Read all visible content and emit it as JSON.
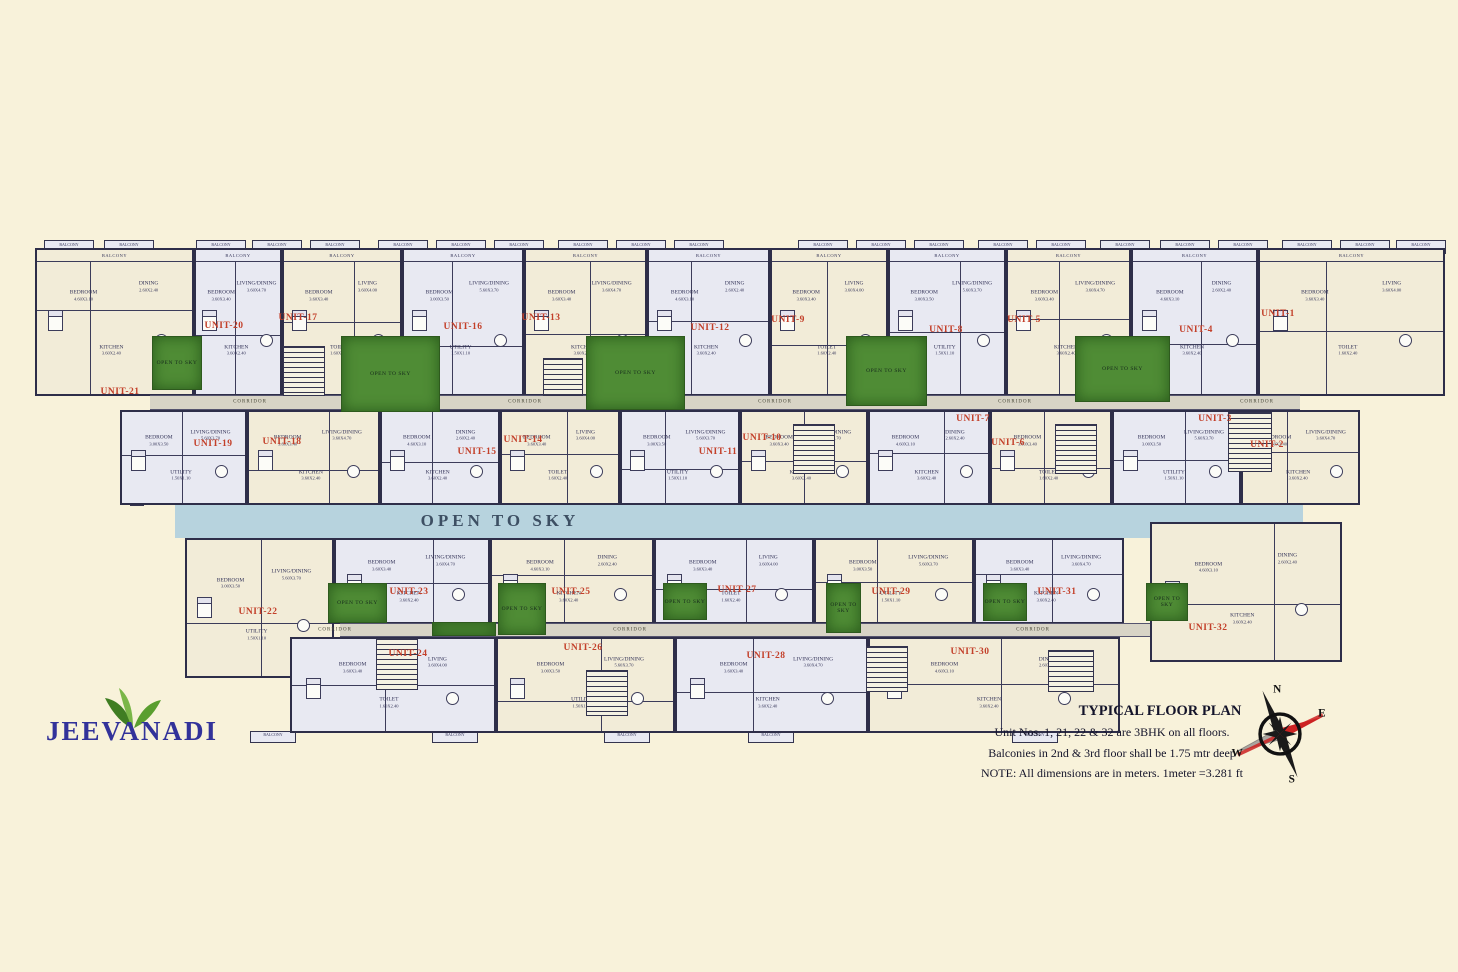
{
  "colors": {
    "background": "#f8f2da",
    "walls": "#2e2e49",
    "room_fill_light": "#e8e9f2",
    "room_fill_cream": "#f2ecd8",
    "open_band_blue": "#b7d3de",
    "courtyard_green": "#4f8c35",
    "unit_label_red": "#c3402a",
    "logo_purple": "#32329a",
    "corridor_gray": "#d8d4c6"
  },
  "logo": {
    "name": "JEEVANADI",
    "leaf_icon": "leaf-icon"
  },
  "notes": {
    "title": "TYPICAL FLOOR PLAN",
    "line1": "Unit Nos. 1, 21, 22 & 32 are 3BHK on all floors.",
    "line2": "Balconies in 2nd & 3rd floor shall be 1.75 mtr deep",
    "line3": "NOTE: All dimensions are in meters. 1meter =3.281 ft"
  },
  "compass": {
    "n": "N",
    "e": "E",
    "s": "S",
    "w": "W"
  },
  "central_band": {
    "label": "OPEN TO SKY"
  },
  "labels": {
    "corridor": "CORRIDOR",
    "open_to_sky": "OPEN TO SKY",
    "balcony": "BALCONY"
  },
  "room_presets": [
    [
      [
        "BEDROOM",
        "3.60X3.40"
      ],
      [
        "LIVING/DINING",
        "3.60X4.70"
      ],
      [
        "KITCHEN",
        "3.60X2.40"
      ]
    ],
    [
      [
        "BEDROOM",
        "4.60X3.10"
      ],
      [
        "DINING",
        "2.60X2.40"
      ],
      [
        "KITCHEN",
        "3.60X2.40"
      ]
    ],
    [
      [
        "BEDROOM",
        "3.60X3.40"
      ],
      [
        "LIVING",
        "3.60X4.00"
      ],
      [
        "TOILET",
        "1.60X2.40"
      ]
    ],
    [
      [
        "BEDROOM",
        "3.00X3.50"
      ],
      [
        "LIVING/DINING",
        "5.60X3.70"
      ],
      [
        "UTILITY",
        "1.50X1.10"
      ]
    ]
  ],
  "units": [
    {
      "label": "UNIT-21",
      "x": 35,
      "y": 248,
      "w": 159,
      "h": 148,
      "lx": 120,
      "ly": 392,
      "v": 1,
      "rp": 1,
      "balcony": true
    },
    {
      "label": "UNIT-20",
      "x": 194,
      "y": 248,
      "w": 88,
      "h": 148,
      "lx": 224,
      "ly": 326,
      "v": 0,
      "rp": 0,
      "balcony": true
    },
    {
      "label": "UNIT-17",
      "x": 282,
      "y": 248,
      "w": 120,
      "h": 148,
      "lx": 298,
      "ly": 318,
      "v": 1,
      "rp": 2,
      "balcony": true
    },
    {
      "label": "UNIT-16",
      "x": 402,
      "y": 248,
      "w": 122,
      "h": 148,
      "lx": 463,
      "ly": 327,
      "v": 0,
      "rp": 3,
      "balcony": true
    },
    {
      "label": "UNIT-13",
      "x": 524,
      "y": 248,
      "w": 123,
      "h": 148,
      "lx": 541,
      "ly": 318,
      "v": 1,
      "rp": 0,
      "balcony": true
    },
    {
      "label": "UNIT-12",
      "x": 647,
      "y": 248,
      "w": 123,
      "h": 148,
      "lx": 710,
      "ly": 328,
      "v": 0,
      "rp": 1,
      "balcony": true
    },
    {
      "label": "UNIT-9",
      "x": 770,
      "y": 248,
      "w": 118,
      "h": 148,
      "lx": 788,
      "ly": 320,
      "v": 1,
      "rp": 2,
      "balcony": true
    },
    {
      "label": "UNIT-8",
      "x": 888,
      "y": 248,
      "w": 118,
      "h": 148,
      "lx": 946,
      "ly": 330,
      "v": 0,
      "rp": 3,
      "balcony": true
    },
    {
      "label": "UNIT-5",
      "x": 1006,
      "y": 248,
      "w": 125,
      "h": 148,
      "lx": 1024,
      "ly": 320,
      "v": 1,
      "rp": 0,
      "balcony": true
    },
    {
      "label": "UNIT-4",
      "x": 1131,
      "y": 248,
      "w": 127,
      "h": 148,
      "lx": 1196,
      "ly": 330,
      "v": 0,
      "rp": 1,
      "balcony": true
    },
    {
      "label": "UNIT-1",
      "x": 1258,
      "y": 248,
      "w": 187,
      "h": 148,
      "lx": 1278,
      "ly": 314,
      "v": 1,
      "rp": 2,
      "balcony": true
    },
    {
      "label": "UNIT-19",
      "x": 120,
      "y": 410,
      "w": 127,
      "h": 95,
      "lx": 213,
      "ly": 444,
      "v": 0,
      "rp": 3,
      "balcony": false
    },
    {
      "label": "UNIT-18",
      "x": 247,
      "y": 410,
      "w": 133,
      "h": 95,
      "lx": 282,
      "ly": 442,
      "v": 1,
      "rp": 0,
      "balcony": false
    },
    {
      "label": "UNIT-15",
      "x": 380,
      "y": 410,
      "w": 120,
      "h": 95,
      "lx": 477,
      "ly": 452,
      "v": 0,
      "rp": 1,
      "balcony": false
    },
    {
      "label": "UNIT-14",
      "x": 500,
      "y": 410,
      "w": 120,
      "h": 95,
      "lx": 523,
      "ly": 440,
      "v": 1,
      "rp": 2,
      "balcony": false
    },
    {
      "label": "UNIT-11",
      "x": 620,
      "y": 410,
      "w": 120,
      "h": 95,
      "lx": 718,
      "ly": 452,
      "v": 0,
      "rp": 3,
      "balcony": false
    },
    {
      "label": "UNIT-10",
      "x": 740,
      "y": 410,
      "w": 128,
      "h": 95,
      "lx": 762,
      "ly": 438,
      "v": 1,
      "rp": 0,
      "balcony": false
    },
    {
      "label": "UNIT-7",
      "x": 868,
      "y": 410,
      "w": 122,
      "h": 95,
      "lx": 973,
      "ly": 419,
      "v": 0,
      "rp": 1,
      "balcony": false
    },
    {
      "label": "UNIT-6",
      "x": 990,
      "y": 410,
      "w": 122,
      "h": 95,
      "lx": 1008,
      "ly": 443,
      "v": 1,
      "rp": 2,
      "balcony": false
    },
    {
      "label": "UNIT-3",
      "x": 1112,
      "y": 410,
      "w": 129,
      "h": 95,
      "lx": 1215,
      "ly": 419,
      "v": 0,
      "rp": 3,
      "balcony": false
    },
    {
      "label": "UNIT-2",
      "x": 1241,
      "y": 410,
      "w": 119,
      "h": 95,
      "lx": 1267,
      "ly": 445,
      "v": 1,
      "rp": 0,
      "balcony": false
    },
    {
      "label": "UNIT-22",
      "x": 185,
      "y": 538,
      "w": 149,
      "h": 140,
      "lx": 258,
      "ly": 612,
      "v": 1,
      "rp": 3,
      "balcony": false
    },
    {
      "label": "UNIT-23",
      "x": 334,
      "y": 538,
      "w": 156,
      "h": 86,
      "lx": 409,
      "ly": 592,
      "v": 0,
      "rp": 0,
      "balcony": false
    },
    {
      "label": "UNIT-25",
      "x": 490,
      "y": 538,
      "w": 164,
      "h": 86,
      "lx": 571,
      "ly": 592,
      "v": 1,
      "rp": 1,
      "balcony": false
    },
    {
      "label": "UNIT-27",
      "x": 654,
      "y": 538,
      "w": 160,
      "h": 86,
      "lx": 737,
      "ly": 590,
      "v": 0,
      "rp": 2,
      "balcony": false
    },
    {
      "label": "UNIT-29",
      "x": 814,
      "y": 538,
      "w": 160,
      "h": 86,
      "lx": 891,
      "ly": 592,
      "v": 1,
      "rp": 3,
      "balcony": false
    },
    {
      "label": "UNIT-31",
      "x": 974,
      "y": 538,
      "w": 150,
      "h": 86,
      "lx": 1057,
      "ly": 592,
      "v": 0,
      "rp": 0,
      "balcony": false
    },
    {
      "label": "UNIT-32",
      "x": 1150,
      "y": 522,
      "w": 192,
      "h": 140,
      "lx": 1208,
      "ly": 628,
      "v": 1,
      "rp": 1,
      "balcony": false
    },
    {
      "label": "UNIT-24",
      "x": 290,
      "y": 637,
      "w": 206,
      "h": 96,
      "lx": 408,
      "ly": 654,
      "v": 0,
      "rp": 2,
      "balcony": false
    },
    {
      "label": "UNIT-26",
      "x": 496,
      "y": 637,
      "w": 179,
      "h": 96,
      "lx": 583,
      "ly": 648,
      "v": 1,
      "rp": 3,
      "balcony": false
    },
    {
      "label": "UNIT-28",
      "x": 675,
      "y": 637,
      "w": 193,
      "h": 96,
      "lx": 766,
      "ly": 656,
      "v": 0,
      "rp": 0,
      "balcony": false
    },
    {
      "label": "UNIT-30",
      "x": 868,
      "y": 637,
      "w": 252,
      "h": 96,
      "lx": 970,
      "ly": 652,
      "v": 1,
      "rp": 1,
      "balcony": false
    }
  ],
  "greens": [
    {
      "x": 152,
      "y": 336,
      "w": 50,
      "h": 54,
      "labeled": true
    },
    {
      "x": 341,
      "y": 336,
      "w": 99,
      "h": 76,
      "labeled": true
    },
    {
      "x": 586,
      "y": 336,
      "w": 99,
      "h": 74,
      "labeled": true
    },
    {
      "x": 846,
      "y": 336,
      "w": 81,
      "h": 70,
      "labeled": true
    },
    {
      "x": 1075,
      "y": 336,
      "w": 95,
      "h": 66,
      "labeled": true
    },
    {
      "x": 328,
      "y": 583,
      "w": 59,
      "h": 40,
      "labeled": true
    },
    {
      "x": 498,
      "y": 583,
      "w": 48,
      "h": 52,
      "labeled": true
    },
    {
      "x": 663,
      "y": 583,
      "w": 44,
      "h": 37,
      "labeled": true
    },
    {
      "x": 826,
      "y": 583,
      "w": 35,
      "h": 50,
      "labeled": true
    },
    {
      "x": 983,
      "y": 583,
      "w": 44,
      "h": 38,
      "labeled": true
    },
    {
      "x": 1146,
      "y": 583,
      "w": 42,
      "h": 38,
      "labeled": true
    },
    {
      "x": 432,
      "y": 622,
      "w": 64,
      "h": 14,
      "labeled": false
    }
  ],
  "band": {
    "x": 175,
    "y": 504,
    "w": 1128,
    "h": 34,
    "label_x": 500,
    "label_y": 521,
    "right_patch": {
      "x": 1195,
      "y": 480,
      "w": 96,
      "h": 26
    }
  },
  "corridors": [
    {
      "x": 150,
      "y": 395,
      "w": 1150,
      "h": 15,
      "labels_x": [
        250,
        525,
        775,
        1015,
        1257
      ],
      "label_y": 402
    },
    {
      "x": 340,
      "y": 623,
      "w": 810,
      "h": 14,
      "labels_x": [
        335,
        630,
        1033
      ],
      "label_y": 630
    }
  ],
  "stairs": [
    {
      "x": 283,
      "y": 346,
      "w": 42,
      "h": 50
    },
    {
      "x": 543,
      "y": 358,
      "w": 40,
      "h": 38
    },
    {
      "x": 793,
      "y": 424,
      "w": 42,
      "h": 50
    },
    {
      "x": 1055,
      "y": 424,
      "w": 42,
      "h": 50
    },
    {
      "x": 1228,
      "y": 412,
      "w": 44,
      "h": 60
    },
    {
      "x": 376,
      "y": 638,
      "w": 42,
      "h": 52
    },
    {
      "x": 586,
      "y": 670,
      "w": 42,
      "h": 46
    },
    {
      "x": 866,
      "y": 646,
      "w": 42,
      "h": 46
    },
    {
      "x": 1048,
      "y": 650,
      "w": 46,
      "h": 42
    }
  ],
  "top_tabs_x": [
    44,
    104,
    196,
    252,
    310,
    378,
    436,
    494,
    558,
    616,
    674,
    798,
    856,
    914,
    978,
    1036,
    1100,
    1160,
    1218,
    1282,
    1340,
    1396
  ],
  "bottom_tabs_x": [
    250,
    432,
    604,
    748,
    1012
  ],
  "side_tab": {
    "x": 130,
    "y": 438,
    "w": 14,
    "h": 68
  }
}
